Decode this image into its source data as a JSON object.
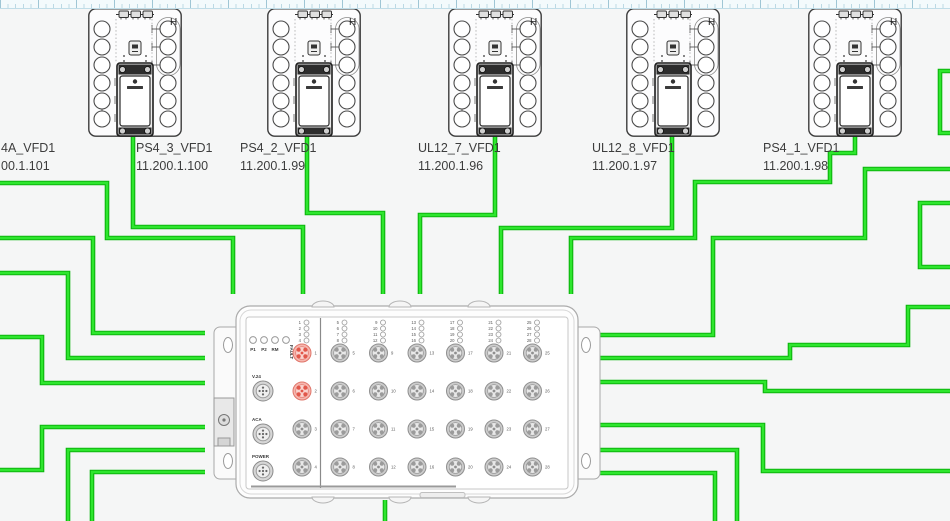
{
  "canvas": {
    "width": 950,
    "height": 521
  },
  "colors": {
    "wire_core": "#2ee62e",
    "wire_edge": "#0cb50c",
    "port_normal_ring": "#cccccc",
    "port_normal_stroke": "#8f8f8f",
    "port_normal_inner": "#e8e8e8",
    "port_normal_petal": "#9b9b9b",
    "port_red_ring": "#f6b6ae",
    "port_red_stroke": "#e0766b",
    "port_red_inner": "#fad3ce",
    "port_red_petal": "#e2574a"
  },
  "vfd": {
    "h_label": "H"
  },
  "devices": [
    {
      "id": "offscreen-left",
      "name": "4A_VFD1",
      "ip": "00.1.101",
      "x": null,
      "label_x": 1,
      "label_y": 152
    },
    {
      "id": "PS4_3",
      "name": "PS4_3_VFD1",
      "ip": "11.200.1.100",
      "x": 88,
      "label_x": 136,
      "label_y": 152
    },
    {
      "id": "PS4_2",
      "name": "PS4_2_VFD1",
      "ip": "11.200.1.99",
      "x": 267,
      "label_x": 240,
      "label_y": 152
    },
    {
      "id": "UL12_7",
      "name": "UL12_7_VFD1",
      "ip": "11.200.1.96",
      "x": 448,
      "label_x": 418,
      "label_y": 152
    },
    {
      "id": "UL12_8",
      "name": "UL12_8_VFD1",
      "ip": "11.200.1.97",
      "x": 626,
      "label_x": 592,
      "label_y": 152
    },
    {
      "id": "PS4_1",
      "name": "PS4_1_VFD1",
      "ip": "11.200.1.98",
      "x": 808,
      "label_x": 763,
      "label_y": 152
    }
  ],
  "switch": {
    "status_leds": [
      "P1",
      "P2",
      "RM",
      "FAULT"
    ],
    "connector_labels": [
      "V.24",
      "ACA",
      "POWER"
    ],
    "port_count": 28,
    "port_numbers": [
      1,
      2,
      3,
      4,
      5,
      6,
      7,
      8,
      9,
      10,
      11,
      12,
      13,
      14,
      15,
      16,
      17,
      18,
      19,
      20,
      21,
      22,
      23,
      24,
      25,
      26,
      27,
      28
    ],
    "highlighted_ports": [
      1,
      2
    ],
    "port_columns_x": [
      302,
      340,
      378.5,
      417,
      455.5,
      494,
      532.5
    ],
    "port_rows_y": [
      353,
      391,
      429,
      467
    ]
  },
  "wires": [
    {
      "id": "left-edge-1",
      "points": [
        [
          0,
          183
        ],
        [
          107,
          183
        ],
        [
          107,
          238
        ],
        [
          233,
          238
        ],
        [
          233,
          294
        ]
      ]
    },
    {
      "id": "left-edge-2",
      "points": [
        [
          0,
          238
        ],
        [
          93,
          238
        ],
        [
          93,
          333
        ],
        [
          205,
          333
        ]
      ]
    },
    {
      "id": "left-edge-3",
      "points": [
        [
          0,
          273
        ],
        [
          68,
          273
        ],
        [
          68,
          358
        ],
        [
          205,
          358
        ]
      ]
    },
    {
      "id": "left-edge-4",
      "points": [
        [
          0,
          337
        ],
        [
          42,
          337
        ],
        [
          42,
          383
        ],
        [
          205,
          383
        ]
      ]
    },
    {
      "id": "left-edge-5",
      "points": [
        [
          0,
          470
        ],
        [
          42,
          470
        ],
        [
          42,
          427
        ],
        [
          205,
          427
        ]
      ]
    },
    {
      "id": "bottom-left-1",
      "points": [
        [
          68,
          521
        ],
        [
          68,
          450
        ],
        [
          205,
          450
        ]
      ]
    },
    {
      "id": "bottom-left-2",
      "points": [
        [
          92,
          521
        ],
        [
          92,
          472
        ],
        [
          205,
          472
        ]
      ]
    },
    {
      "id": "vfd-ps4-3",
      "points": [
        [
          133,
          136
        ],
        [
          133,
          227
        ],
        [
          303,
          227
        ],
        [
          303,
          294
        ]
      ]
    },
    {
      "id": "vfd-ps4-2",
      "points": [
        [
          307,
          136
        ],
        [
          307,
          213
        ],
        [
          383,
          213
        ],
        [
          383,
          294
        ]
      ]
    },
    {
      "id": "vfd-ul12-7",
      "points": [
        [
          495,
          136
        ],
        [
          495,
          215
        ],
        [
          420,
          215
        ],
        [
          420,
          294
        ]
      ]
    },
    {
      "id": "vfd-ul12-8",
      "points": [
        [
          672,
          136
        ],
        [
          672,
          228
        ],
        [
          501,
          228
        ],
        [
          501,
          294
        ]
      ]
    },
    {
      "id": "vfd-ps4-1",
      "points": [
        [
          855,
          136
        ],
        [
          855,
          153
        ],
        [
          830,
          153
        ],
        [
          830,
          182
        ],
        [
          695,
          182
        ],
        [
          695,
          238
        ],
        [
          571,
          238
        ],
        [
          571,
          294
        ]
      ]
    },
    {
      "id": "right-jog-1",
      "points": [
        [
          950,
          71
        ],
        [
          940,
          71
        ],
        [
          940,
          133
        ],
        [
          950,
          133
        ]
      ]
    },
    {
      "id": "right-edge-1",
      "points": [
        [
          950,
          169
        ],
        [
          865,
          169
        ],
        [
          865,
          238
        ],
        [
          713,
          238
        ],
        [
          713,
          335
        ],
        [
          598,
          335
        ]
      ]
    },
    {
      "id": "right-jog-2",
      "points": [
        [
          950,
          203
        ],
        [
          920,
          203
        ],
        [
          920,
          267
        ],
        [
          950,
          267
        ]
      ]
    },
    {
      "id": "right-edge-2",
      "points": [
        [
          598,
          358
        ],
        [
          790,
          358
        ],
        [
          790,
          345
        ],
        [
          908,
          345
        ],
        [
          908,
          307
        ],
        [
          950,
          307
        ]
      ]
    },
    {
      "id": "right-edge-3",
      "points": [
        [
          598,
          382
        ],
        [
          765,
          382
        ],
        [
          765,
          391
        ],
        [
          950,
          391
        ]
      ]
    },
    {
      "id": "right-edge-4",
      "points": [
        [
          598,
          425
        ],
        [
          763,
          425
        ],
        [
          763,
          471
        ],
        [
          950,
          471
        ]
      ]
    },
    {
      "id": "bottom-right-1",
      "points": [
        [
          598,
          450
        ],
        [
          737,
          450
        ],
        [
          737,
          521
        ]
      ]
    },
    {
      "id": "bottom-right-2",
      "points": [
        [
          598,
          473
        ],
        [
          715,
          473
        ],
        [
          715,
          521
        ]
      ]
    },
    {
      "id": "switch-bottom",
      "points": [
        [
          385,
          500
        ],
        [
          385,
          521
        ]
      ]
    }
  ]
}
